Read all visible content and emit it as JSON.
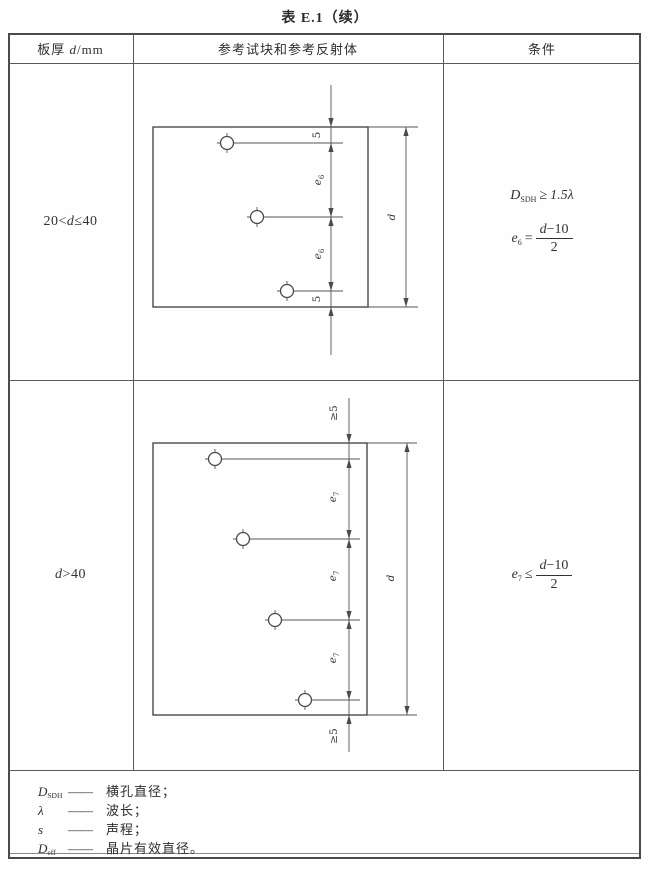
{
  "title": "表 E.1（续）",
  "accent_colors": {
    "line": "#555555",
    "text": "#333333",
    "frame": "#4a4a4a"
  },
  "table": {
    "header1_pre": "板厚 ",
    "header1_var": "d",
    "header1_post": "/mm",
    "header2": "参考试块和参考反射体",
    "header3": "条件"
  },
  "rows": [
    {
      "thickness_pre": "20<",
      "thickness_var": "d",
      "thickness_post": "≤40",
      "cond_sdh": {
        "base": "D",
        "sub": "SDH",
        "rel": "≥",
        "value": "1.5λ"
      },
      "cond_e": {
        "base": "e",
        "sub": "6",
        "rel": "=",
        "num_var": "d",
        "num_rest": "−10",
        "den": "2"
      },
      "diagram": {
        "dim_top": "5",
        "dim_between": "e",
        "dim_between_sub": "6",
        "dim_bottom": "5",
        "height_label": "d"
      }
    },
    {
      "thickness_pre": "",
      "thickness_var": "d",
      "thickness_post": ">40",
      "cond_e": {
        "base": "e",
        "sub": "7",
        "rel": "≤",
        "num_var": "d",
        "num_rest": "−10",
        "den": "2"
      },
      "diagram": {
        "dim_top": "≥5",
        "dim_between": "e",
        "dim_between_sub": "7",
        "dim_bottom": "≥5",
        "height_label": "d"
      }
    }
  ],
  "notes": [
    {
      "term_base": "D",
      "term_sub": "SDH",
      "dash": "——",
      "definition": "横孔直径；"
    },
    {
      "term_base": "λ",
      "term_sub": "",
      "dash": "——",
      "definition": "波长；"
    },
    {
      "term_base": "s",
      "term_sub": "",
      "dash": "——",
      "definition": "声程；"
    },
    {
      "term_base": "D",
      "term_sub": "eff",
      "dash": "——",
      "definition": "晶片有效直径。"
    }
  ]
}
